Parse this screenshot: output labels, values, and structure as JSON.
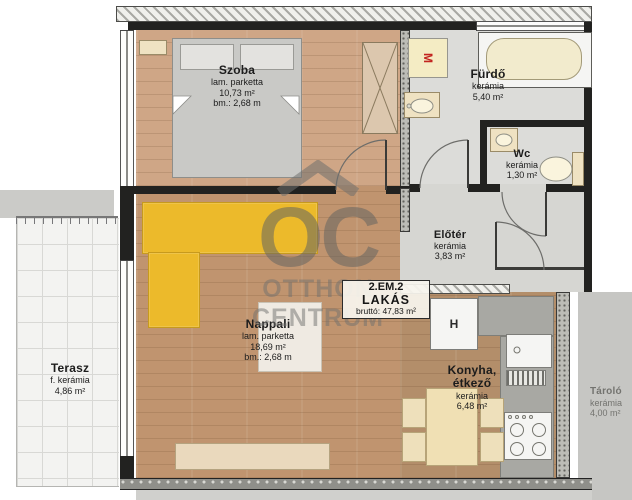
{
  "apartment": {
    "unit": "2.EM.2",
    "type": "LAKÁS",
    "gross_area": "bruttó: 47,83 m²"
  },
  "watermark": {
    "initials": "OC",
    "line1": "OTTHON",
    "line2": "CENTRUM"
  },
  "rooms": [
    {
      "id": "szoba",
      "name": "Szoba",
      "material": "lam. parketta",
      "area": "10,73 m²",
      "height": "bm.: 2,68 m"
    },
    {
      "id": "furdo",
      "name": "Fürdő",
      "material": "kerámia",
      "area": "5,40 m²",
      "height": ""
    },
    {
      "id": "wc",
      "name": "Wc",
      "material": "kerámia",
      "area": "1,30 m²",
      "height": ""
    },
    {
      "id": "eloter",
      "name": "Előtér",
      "material": "kerámia",
      "area": "3,83 m²",
      "height": ""
    },
    {
      "id": "nappali",
      "name": "Nappali",
      "material": "lam. parketta",
      "area": "18,69 m²",
      "height": "bm.: 2,68 m"
    },
    {
      "id": "konyha",
      "name": "Konyha, étkező",
      "material": "kerámia",
      "area": "6,48 m²",
      "height": ""
    },
    {
      "id": "terasz",
      "name": "Terasz",
      "material": "f. kerámia",
      "area": "4,86 m²",
      "height": ""
    },
    {
      "id": "tarolo",
      "name": "Tároló",
      "material": "kerámia",
      "area": "4,00 m²",
      "height": ""
    }
  ],
  "appliances": {
    "washing_machine_label": "M",
    "fridge_label": "H"
  },
  "colors": {
    "sofa_accent": "#ecba2b",
    "washing_machine_letter": "#c2241f",
    "wall_dark": "#222220",
    "wood_living": "#c0946f",
    "wood_bedroom": "#cfa686",
    "wood_kitchen": "#b38e6a",
    "tile_light_gray": "#dcdcd9",
    "terrace_white": "#f3f3f1",
    "furniture_cream": "#efe2c2",
    "watermark_gray": "#70706d"
  }
}
